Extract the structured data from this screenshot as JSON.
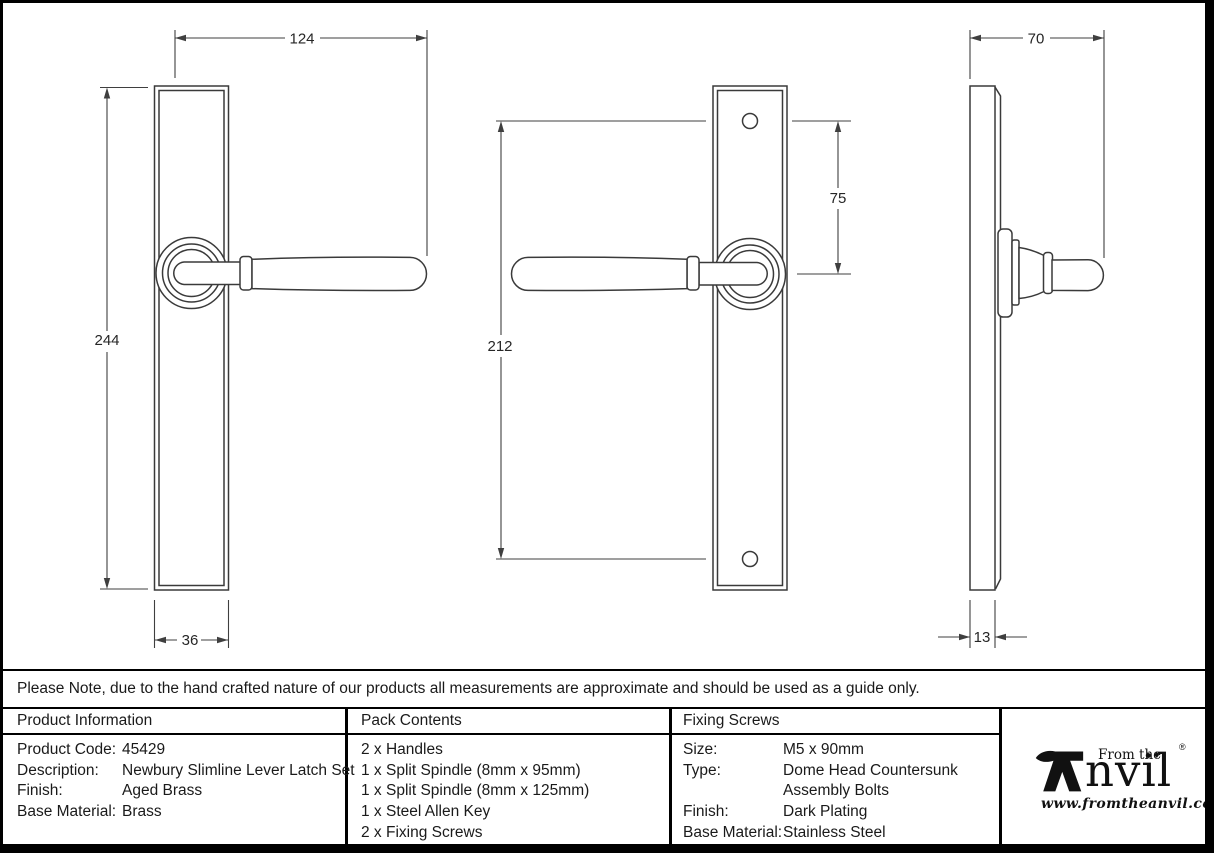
{
  "note": {
    "text": "Please Note, due to the hand crafted nature of our products all measurements are approximate and should be used as a guide only."
  },
  "drawings": {
    "front_view": {
      "dim_overall_width": "124",
      "dim_plate_height": "244",
      "dim_plate_width": "36"
    },
    "reverse_view": {
      "dim_screw_centres": "212",
      "dim_top_to_handle_centre": "75"
    },
    "side_view": {
      "dim_projection": "70",
      "dim_plate_thickness": "13"
    }
  },
  "table": {
    "product_information": {
      "header": "Product Information",
      "rows": [
        {
          "label": "Product Code:",
          "value": "45429"
        },
        {
          "label": "Description:",
          "value": "Newbury Slimline Lever Latch Set"
        },
        {
          "label": "Finish:",
          "value": "Aged Brass"
        },
        {
          "label": "Base Material:",
          "value": "Brass"
        }
      ]
    },
    "pack_contents": {
      "header": "Pack Contents",
      "items": [
        "2 x Handles",
        "1 x Split Spindle (8mm x 95mm)",
        "1 x Split Spindle (8mm x 125mm)",
        "1 x Steel Allen Key",
        "2 x Fixing Screws"
      ]
    },
    "fixing_screws": {
      "header": "Fixing Screws",
      "rows": [
        {
          "label": "Size:",
          "value": "M5 x 90mm"
        },
        {
          "label": "Type:",
          "value": "Dome Head Countersunk"
        },
        {
          "label": "",
          "value": "Assembly Bolts"
        },
        {
          "label": "Finish:",
          "value": "Dark Plating"
        },
        {
          "label": "Base Material:",
          "value": "Stainless Steel"
        }
      ]
    }
  },
  "logo": {
    "prefix": "From the",
    "diamond": "♦",
    "brand_rest": "nvil",
    "registered": "®",
    "url": "www.fromtheanvil.co.uk"
  },
  "colors": {
    "line": "#3a3a3a",
    "border": "#000000",
    "text": "#1a1a1a"
  }
}
